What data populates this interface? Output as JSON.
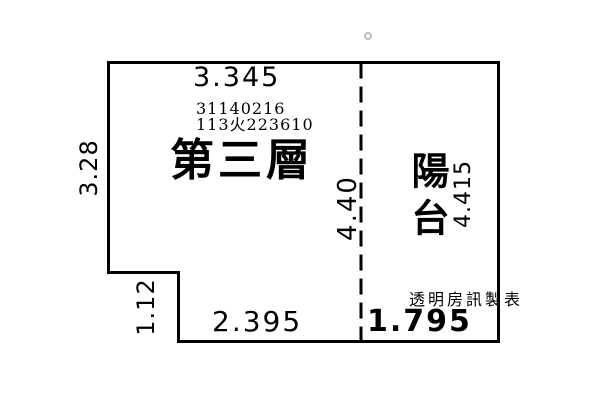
{
  "rooms": {
    "main_floor": {
      "label": "第三層"
    },
    "balcony": {
      "label": "陽台"
    }
  },
  "registry_numbers": {
    "line1": "31140216",
    "line2": "113火223610"
  },
  "dimensions": {
    "top_width": "3.345",
    "left_height": "3.28",
    "left_lower_height": "1.12",
    "divider_height": "4.40",
    "balcony_height": "4.415",
    "bottom_main_width": "2.395",
    "bottom_balcony_width": "1.795"
  },
  "watermark": "透明房訊製表",
  "colors": {
    "line": "#000000",
    "background": "#ffffff",
    "registration_mark": "#bdbdbd"
  }
}
